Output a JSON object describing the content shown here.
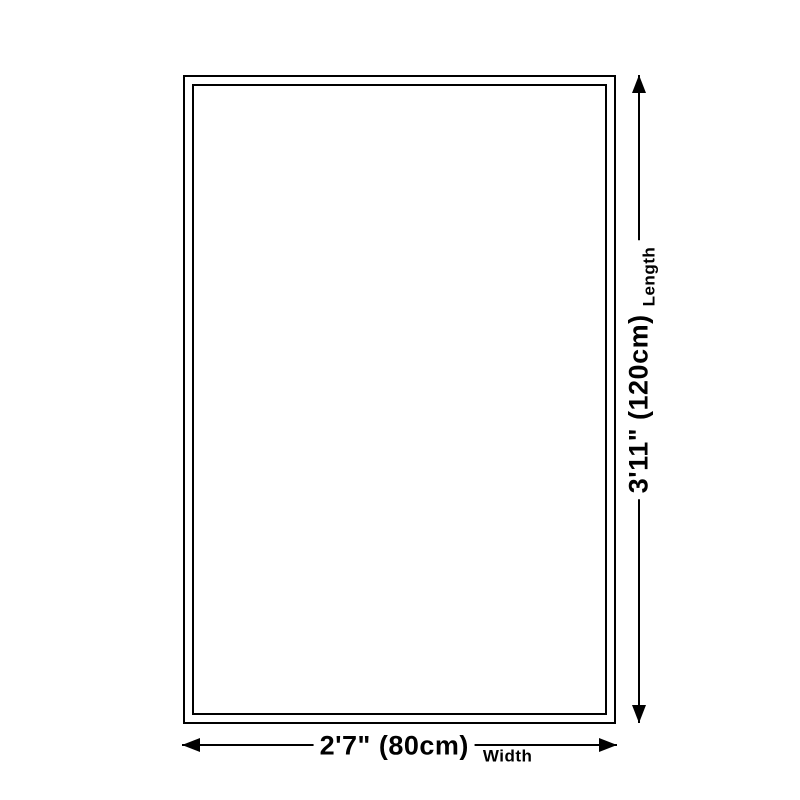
{
  "diagram": {
    "length": {
      "value": "3'11\" (120cm)",
      "caption": "Length"
    },
    "width": {
      "value": "2'7\" (80cm)",
      "caption": "Width"
    },
    "colors": {
      "line": "#000000",
      "background": "#ffffff"
    }
  }
}
